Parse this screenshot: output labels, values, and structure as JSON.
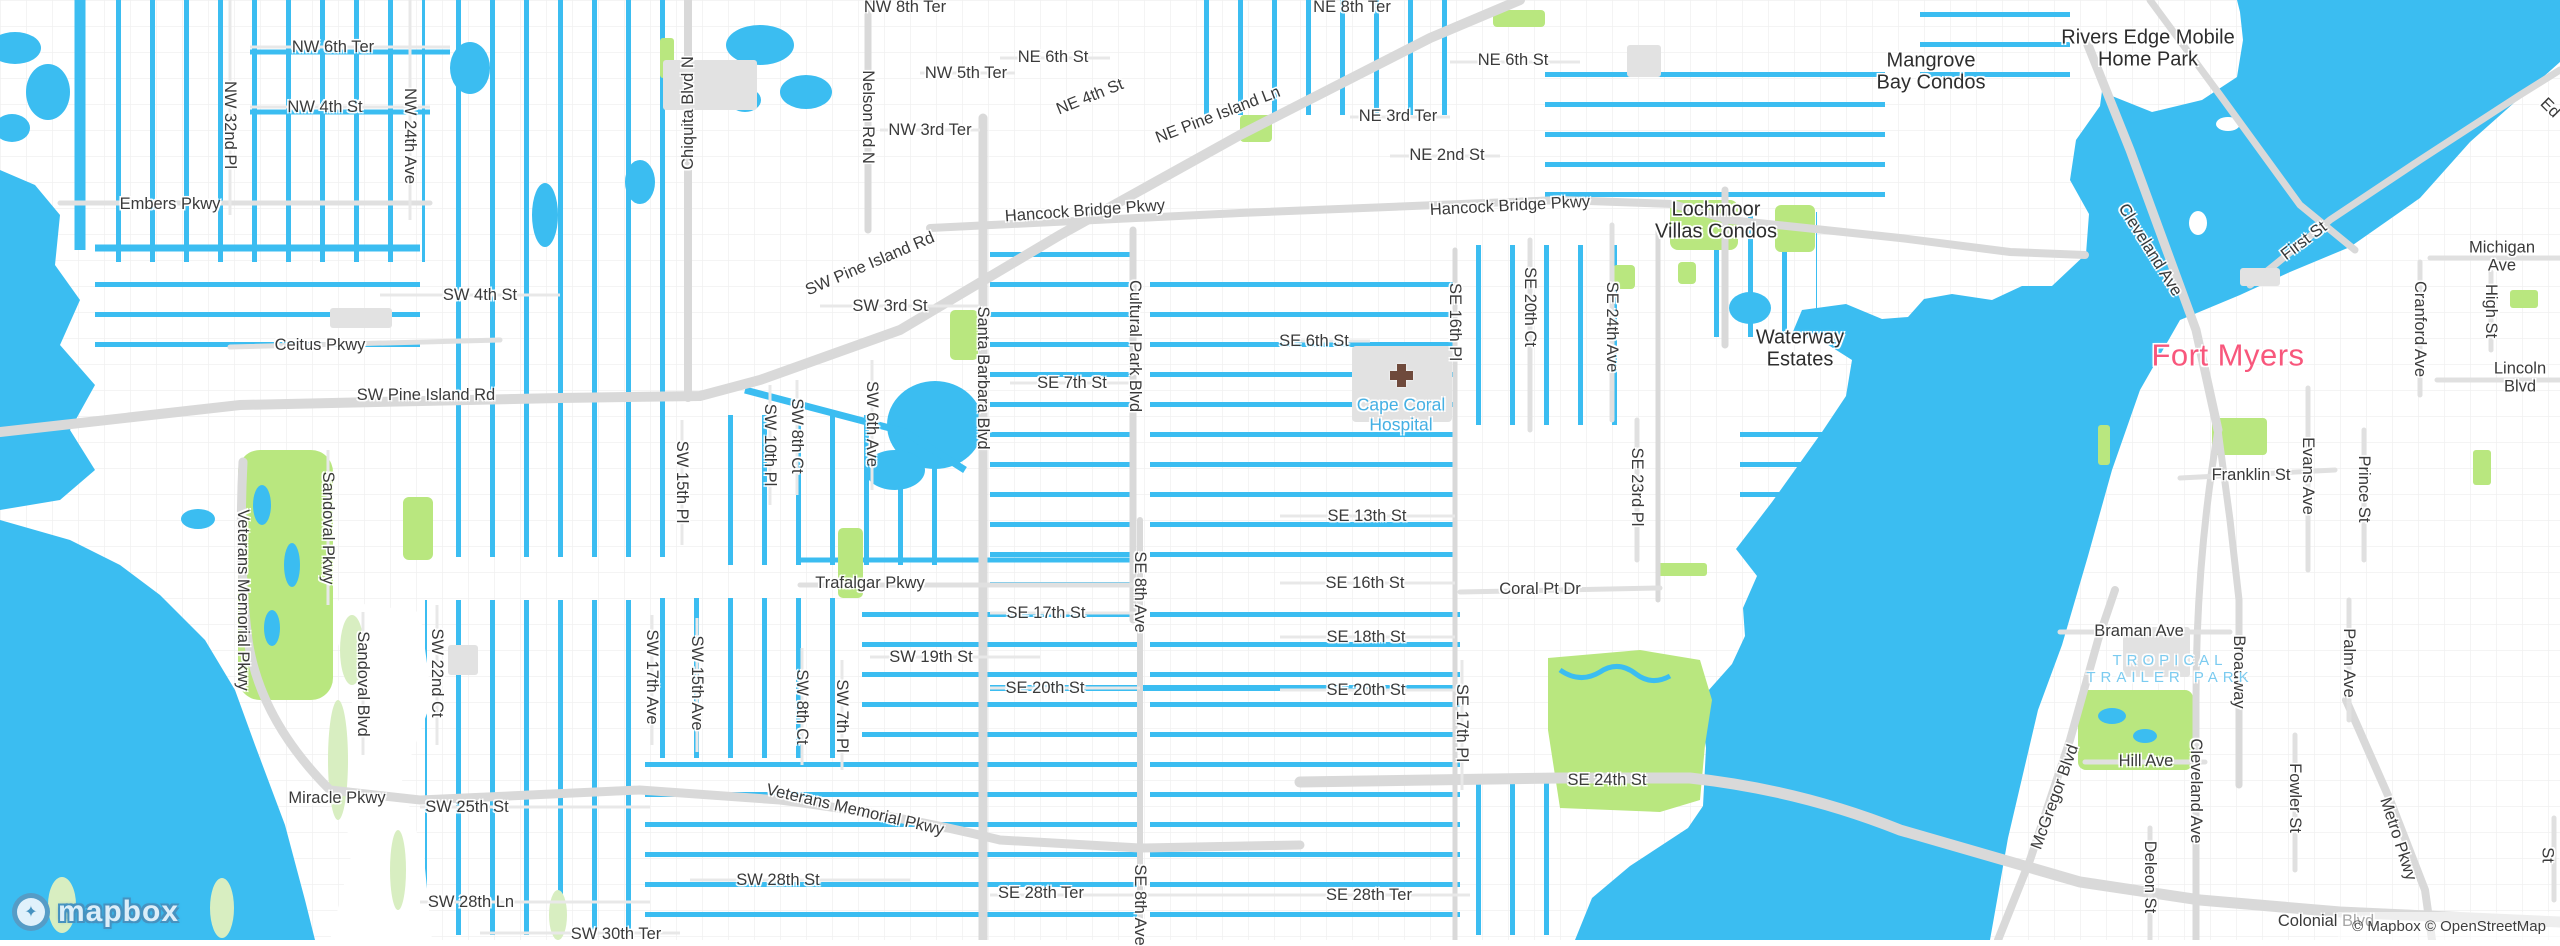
{
  "attribution": {
    "text": "© Mapbox © OpenStreetMap"
  },
  "logo": {
    "text": "mapbox",
    "icon": "mapbox-pin-star"
  },
  "colors": {
    "water": "#3bbdf1",
    "land": "#ffffff",
    "park": "#b9e77f",
    "wetland": "#d8eec1",
    "road_major": "#d9d9d9",
    "road_minor": "#efefef",
    "building": "#e2e2e2",
    "label_dark": "#3a3a3a",
    "label_place": "#2e2e2e",
    "label_city_pink": "#f8577c",
    "label_water_blue": "#44b0e4",
    "hospital_cross": "#6f4a3c"
  },
  "map": {
    "city": "Cape Coral / Fort Myers, Florida",
    "labels": [
      {
        "t": "NW 6th Ter",
        "x": 333,
        "y": 47
      },
      {
        "t": "NW 4th St",
        "x": 325,
        "y": 107
      },
      {
        "t": "Embers Pkwy",
        "x": 170,
        "y": 204
      },
      {
        "t": "NW 8th Ter",
        "x": 905,
        "y": 7
      },
      {
        "t": "NE 8th Ter",
        "x": 1352,
        "y": 7
      },
      {
        "t": "NW 5th Ter",
        "x": 966,
        "y": 73
      },
      {
        "t": "NE 6th St",
        "x": 1053,
        "y": 57
      },
      {
        "t": "NE 6th St",
        "x": 1513,
        "y": 60
      },
      {
        "t": "NW 3rd Ter",
        "x": 930,
        "y": 130
      },
      {
        "t": "NE 3rd Ter",
        "x": 1398,
        "y": 116
      },
      {
        "t": "NE 2nd St",
        "x": 1447,
        "y": 155
      },
      {
        "t": "NE 4th St",
        "x": 1090,
        "y": 97,
        "r": -22
      },
      {
        "t": "NE Pine Island Ln",
        "x": 1218,
        "y": 115,
        "r": -21
      },
      {
        "t": "SW Pine Island Rd",
        "x": 870,
        "y": 264,
        "r": -23
      },
      {
        "t": "Hancock Bridge Pkwy",
        "x": 1085,
        "y": 211,
        "r": -4
      },
      {
        "t": "Hancock Bridge Pkwy",
        "x": 1510,
        "y": 206,
        "r": -3
      },
      {
        "t": "SW 4th St",
        "x": 480,
        "y": 295
      },
      {
        "t": "SW 3rd St",
        "x": 890,
        "y": 306
      },
      {
        "t": "Ceitus Pkwy",
        "x": 320,
        "y": 345
      },
      {
        "t": "SW Pine Island Rd",
        "x": 426,
        "y": 395
      },
      {
        "t": "SE 7th St",
        "x": 1072,
        "y": 383
      },
      {
        "t": "SE 6th St",
        "x": 1314,
        "y": 341
      },
      {
        "t": "SE 13th St",
        "x": 1367,
        "y": 516
      },
      {
        "t": "SE 16th St",
        "x": 1365,
        "y": 583
      },
      {
        "t": "Trafalgar Pkwy",
        "x": 870,
        "y": 583
      },
      {
        "t": "SE 17th St",
        "x": 1046,
        "y": 613
      },
      {
        "t": "SW 19th St",
        "x": 931,
        "y": 657
      },
      {
        "t": "SE 20th St",
        "x": 1045,
        "y": 688
      },
      {
        "t": "SE 18th St",
        "x": 1366,
        "y": 637
      },
      {
        "t": "SE 20th St",
        "x": 1366,
        "y": 690
      },
      {
        "t": "Coral Pt Dr",
        "x": 1540,
        "y": 589
      },
      {
        "t": "SE 24th St",
        "x": 1607,
        "y": 780
      },
      {
        "t": "SE 28th Ter",
        "x": 1041,
        "y": 893
      },
      {
        "t": "SE 28th Ter",
        "x": 1369,
        "y": 895
      },
      {
        "t": "SW 28th St",
        "x": 778,
        "y": 880
      },
      {
        "t": "SW 28th Ln",
        "x": 471,
        "y": 902
      },
      {
        "t": "SW 25th St",
        "x": 467,
        "y": 807
      },
      {
        "t": "Miracle Pkwy",
        "x": 337,
        "y": 798
      },
      {
        "t": "SW 30th Ter",
        "x": 616,
        "y": 934
      },
      {
        "t": "Veterans Memorial Pkwy",
        "x": 855,
        "y": 810,
        "r": 13
      },
      {
        "t": "Braman Ave",
        "x": 2139,
        "y": 631
      },
      {
        "t": "Hill Ave",
        "x": 2146,
        "y": 761
      },
      {
        "t": "Franklin St",
        "x": 2251,
        "y": 475
      },
      {
        "t": "Lincoln Blvd",
        "x": 2520,
        "y": 378
      },
      {
        "t": "Michigan Ave",
        "x": 2502,
        "y": 257
      },
      {
        "t": "Colonial Blvd",
        "x": 2326,
        "y": 921
      },
      {
        "t": "First St",
        "x": 2304,
        "y": 241,
        "r": -37
      },
      {
        "t": "Cleveland Ave",
        "x": 2150,
        "y": 250,
        "r": 58
      },
      {
        "t": "McGregor Blvd",
        "x": 2055,
        "y": 797,
        "r": -70
      },
      {
        "t": "Metro Pkwy",
        "x": 2398,
        "y": 839,
        "r": 72
      },
      {
        "t": "Ed",
        "x": 2550,
        "y": 108,
        "r": 45
      },
      {
        "t": "NW 32nd Pl",
        "x": 230,
        "y": 125,
        "c": "rv"
      },
      {
        "t": "NW 24th Ave",
        "x": 410,
        "y": 136,
        "c": "rv"
      },
      {
        "t": "Nelson Rd N",
        "x": 868,
        "y": 117,
        "c": "rv"
      },
      {
        "t": "Chiquita Blvd N",
        "x": 688,
        "y": 113,
        "c": "rvu"
      },
      {
        "t": "Veterans Memorial Pkwy",
        "x": 243,
        "y": 600,
        "c": "rv"
      },
      {
        "t": "Sandoval Pkwy",
        "x": 328,
        "y": 528,
        "c": "rv"
      },
      {
        "t": "Sandoval Blvd",
        "x": 363,
        "y": 684,
        "c": "rv"
      },
      {
        "t": "SW 22nd Ct",
        "x": 437,
        "y": 673,
        "c": "rv"
      },
      {
        "t": "SW 17th Ave",
        "x": 652,
        "y": 677,
        "c": "rv"
      },
      {
        "t": "SW 15th Ave",
        "x": 697,
        "y": 683,
        "c": "rv"
      },
      {
        "t": "SW 8th Ct",
        "x": 802,
        "y": 707,
        "c": "rv"
      },
      {
        "t": "SW 7th Pl",
        "x": 842,
        "y": 716,
        "c": "rv"
      },
      {
        "t": "SW 15th Pl",
        "x": 682,
        "y": 482,
        "c": "rv"
      },
      {
        "t": "SW 10th Pl",
        "x": 770,
        "y": 445,
        "c": "rv"
      },
      {
        "t": "SW 8th Ct",
        "x": 797,
        "y": 436,
        "c": "rv"
      },
      {
        "t": "SW 6th Ave",
        "x": 872,
        "y": 424,
        "c": "rv"
      },
      {
        "t": "Santa Barbara Blvd",
        "x": 983,
        "y": 378,
        "c": "rv"
      },
      {
        "t": "Cultural Park Blvd",
        "x": 1135,
        "y": 346,
        "c": "rv"
      },
      {
        "t": "SE 8th Ave",
        "x": 1140,
        "y": 592,
        "c": "rv"
      },
      {
        "t": "SE 8th Ave",
        "x": 1140,
        "y": 905,
        "c": "rv"
      },
      {
        "t": "SE 16th Pl",
        "x": 1455,
        "y": 322,
        "c": "rv"
      },
      {
        "t": "SE 20th Ct",
        "x": 1530,
        "y": 307,
        "c": "rv"
      },
      {
        "t": "SE 24th Ave",
        "x": 1612,
        "y": 327,
        "c": "rv"
      },
      {
        "t": "SE 23rd Pl",
        "x": 1637,
        "y": 487,
        "c": "rv"
      },
      {
        "t": "SE 17th Pl",
        "x": 1462,
        "y": 723,
        "c": "rv"
      },
      {
        "t": "Evans Ave",
        "x": 2308,
        "y": 476,
        "c": "rv"
      },
      {
        "t": "Prince St",
        "x": 2364,
        "y": 489,
        "c": "rv"
      },
      {
        "t": "Cranford Ave",
        "x": 2420,
        "y": 329,
        "c": "rv"
      },
      {
        "t": "High St",
        "x": 2491,
        "y": 311,
        "c": "rv"
      },
      {
        "t": "Broadway",
        "x": 2239,
        "y": 672,
        "c": "rv"
      },
      {
        "t": "Palm Ave",
        "x": 2349,
        "y": 663,
        "c": "rv"
      },
      {
        "t": "Cleveland Ave",
        "x": 2196,
        "y": 791,
        "c": "rv"
      },
      {
        "t": "Fowler St",
        "x": 2295,
        "y": 798,
        "c": "rv"
      },
      {
        "t": "Deleon St",
        "x": 2150,
        "y": 877,
        "c": "rv"
      },
      {
        "t": "Ford St",
        "x": 2556,
        "y": 855,
        "c": "rv"
      },
      {
        "t": "Rivers Edge Mobile\nHome Park",
        "x": 2148,
        "y": 49,
        "c": "place"
      },
      {
        "t": "Mangrove\nBay Condos",
        "x": 1931,
        "y": 72,
        "c": "place"
      },
      {
        "t": "Lochmoor\nVillas Condos",
        "x": 1716,
        "y": 221,
        "c": "place"
      },
      {
        "t": "Waterway\nEstates",
        "x": 1800,
        "y": 349,
        "c": "place"
      },
      {
        "t": "Fort Myers",
        "x": 2228,
        "y": 356,
        "c": "city"
      },
      {
        "t": "Cape Coral\nHospital",
        "x": 1401,
        "y": 415,
        "c": "wp"
      },
      {
        "t": "TROPICAL\nTRAILER PARK",
        "x": 2170,
        "y": 670,
        "c": "wpc"
      }
    ]
  }
}
